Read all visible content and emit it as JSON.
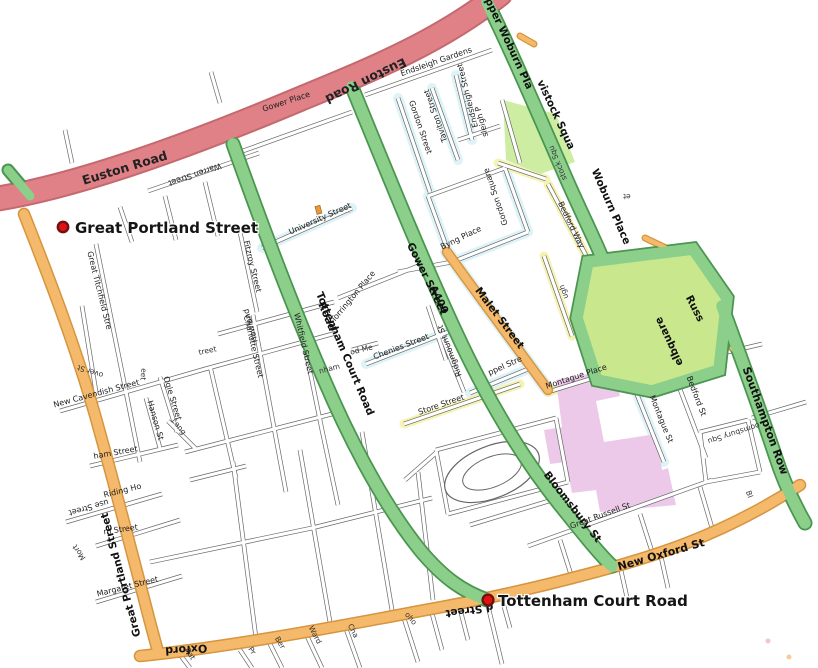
{
  "map": {
    "stations": {
      "great_portland_street": {
        "name": "Great Portland Street"
      },
      "tottenham_court_road": {
        "name": "Tottenham Court Road"
      }
    },
    "labels": {
      "euston_road": "Euston Road",
      "upper_woburn": "pper Woburn Pla",
      "tavistock_sq_road": "vistock Squa",
      "woburn_place": "Woburn Place",
      "gower_street": "Gower Street",
      "a400": "A400",
      "tottenham_court_road": "Tottenham Court Road",
      "road_fragment": "Road",
      "malet_street": "Malet Street",
      "bloomsbury_st": "Bloomsbury St",
      "new_oxford_st": "New Oxford St",
      "southampton_row": "Southampton Row",
      "russ": "Russ",
      "elbquare": "elbquare",
      "oxford": "Oxford",
      "d_street": "d Street",
      "great_portland_street_road": "Great Portland Street",
      "warren_street": "Warren Street",
      "gower_place": "Gower Place",
      "university_street": "University Street",
      "endsleigh_gardens": "Endsleigh Gardens",
      "endsleigh_street": "Endsleigh Street",
      "taviton_street": "Taviton Street",
      "endsleigh_place": "sleigh P",
      "gordon_street": "Gordon Street",
      "gordon_square": "Gordon Square",
      "byng_place": "Byng Place",
      "bedford_way": "Bedford Way",
      "stock_squ": "stock Squ",
      "thornhaugh": "ugh",
      "et_fragment": "et",
      "torrington_place": "Torrington Place",
      "chenies_street": "Chenies Street",
      "ridgmount_st": "Ridgmount St",
      "store_street": "Store Street",
      "keppel_street": "ppel Stre",
      "montague_place": "Montague Place",
      "montague_st": "Montague St",
      "bedford_st": "Bedford St",
      "bloomsbury_squ": "oomsbury Squ",
      "bl_fragment": "Bl",
      "great_russell_st": "Great Russell St",
      "fitzroy_street": "Fitzroy Street",
      "charlotte_street": "Charlotte Street",
      "whitfield_street": "Whitfield Street",
      "howland": "Howland",
      "nham_fragment": "nham",
      "od_me_fragment": "od Me",
      "treet_fragment": "treet",
      "great_titchfield": "Great Titchfield Stre",
      "new_cavendish_street": "New Cavendish Street",
      "over_st_fragment": "over St",
      "eet_fragment": "eet",
      "ogle_street": "Ogle Street",
      "hanson_st": "Hanson St",
      "lang_fragment": "Lang",
      "ham_street_fragment": "ham Street",
      "use_street_fragment": "use Street",
      "riding_ho_fragment": "Riding Ho",
      "m_street_fragment": "m Street",
      "mort_fragment": "Mort",
      "margaret_street": "Margaret Street",
      "rat_fragment": "Rat",
      "pr_fragment": "Pr",
      "ber_fragment": "Ber",
      "ward_fragment": "Ward",
      "cha_fragment": "Cha",
      "oho_fragment": "oho",
      "poi_small_red": "····"
    },
    "colors": {
      "euston_road": "#df8186",
      "euston_border": "#c46a6f",
      "orange_road": "#f4b96b",
      "orange_border": "#d6953e",
      "green_road": "#8ccf8b",
      "green_border": "#4a9550",
      "park_fill": "#cdeda2",
      "russell_park_fill": "#c9e88d",
      "museum_fill": "#ecc9e9",
      "station_red": "#e11212",
      "station_ring": "#70100f",
      "glow_cyan": "#c9ecf4",
      "glow_yellow": "#f4f0a0",
      "poi_orange": "#e8983d"
    }
  }
}
